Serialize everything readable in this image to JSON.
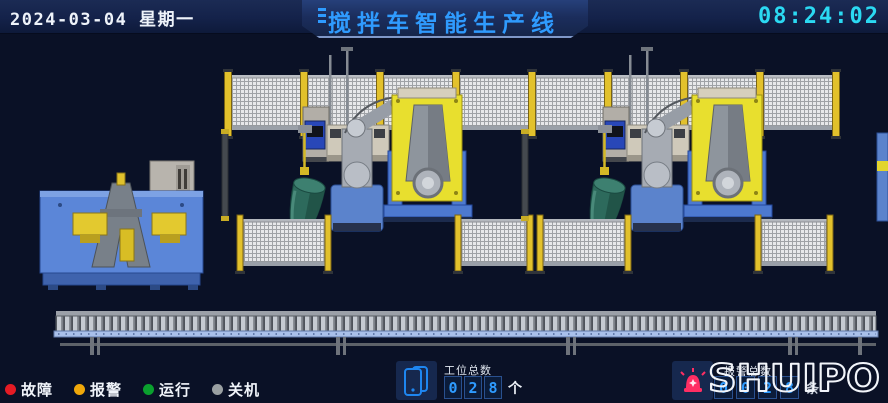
{
  "header": {
    "date": "2024-03-04 星期一",
    "title": "搅拌车智能生产线",
    "time": "08:24:02"
  },
  "scene": {
    "robot_brand": "KUKA"
  },
  "footer": {
    "legend": [
      {
        "label": "故障",
        "color": "#e51b24"
      },
      {
        "label": "报警",
        "color": "#f0a80a"
      },
      {
        "label": "运行",
        "color": "#0aa02e"
      },
      {
        "label": "关机",
        "color": "#9aa0a2"
      }
    ],
    "station_counter": {
      "label": "工位总数",
      "digits": [
        "0",
        "2",
        "8"
      ],
      "unit": "个"
    },
    "alarm_counter": {
      "label": "报警总数",
      "digits": [
        "0",
        "0",
        "2",
        "8"
      ],
      "unit": "条"
    },
    "logo": "SHUIPO"
  },
  "colors": {
    "title_blue": "#2f9bfe",
    "time_cyan": "#2bd9f2",
    "background": "#0a1126",
    "fault_red": "#e51b24",
    "alarm_orange": "#f0a80a",
    "run_green": "#0aa02e",
    "off_gray": "#9aa0a2",
    "machine_yellow": "#e8df2e",
    "machine_blue": "#5b83cc",
    "drum_green": "#2d6a5c"
  }
}
